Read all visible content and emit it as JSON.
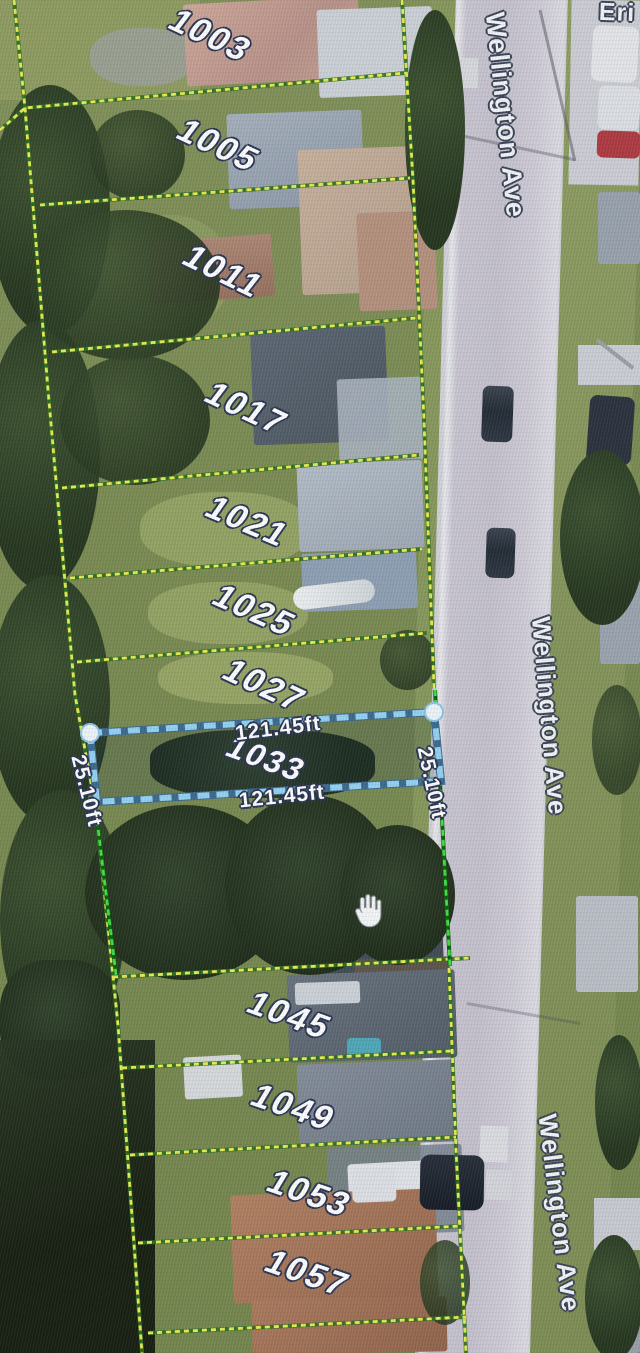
{
  "map": {
    "streets": [
      {
        "id": "wellington-top",
        "text": "Wellington Ave"
      },
      {
        "id": "wellington-middle",
        "text": "Wellington Ave"
      },
      {
        "id": "wellington-bottom",
        "text": "Wellington Ave"
      },
      {
        "id": "cross-street-partial",
        "text": "Eri"
      }
    ],
    "lots": [
      {
        "number": "1003"
      },
      {
        "number": "1005"
      },
      {
        "number": "1011"
      },
      {
        "number": "1017"
      },
      {
        "number": "1021"
      },
      {
        "number": "1025"
      },
      {
        "number": "1027"
      },
      {
        "number": "1033"
      },
      {
        "number": "1045"
      },
      {
        "number": "1049"
      },
      {
        "number": "1053"
      },
      {
        "number": "1057"
      }
    ],
    "selected_parcel": {
      "number": "1033",
      "top_dimension": "121.45ft",
      "bottom_dimension": "121.45ft",
      "left_dimension": "25.10ft",
      "right_dimension": "25.10ft"
    },
    "colors": {
      "parcel_line_yellow": "#e9ec52",
      "parcel_line_green": "#3fe03f",
      "selected_parcel_blue": "#93d2f4",
      "label_text": "#ffffff",
      "label_outline": "#2a3554",
      "road_surface": "#cac7d3"
    }
  }
}
